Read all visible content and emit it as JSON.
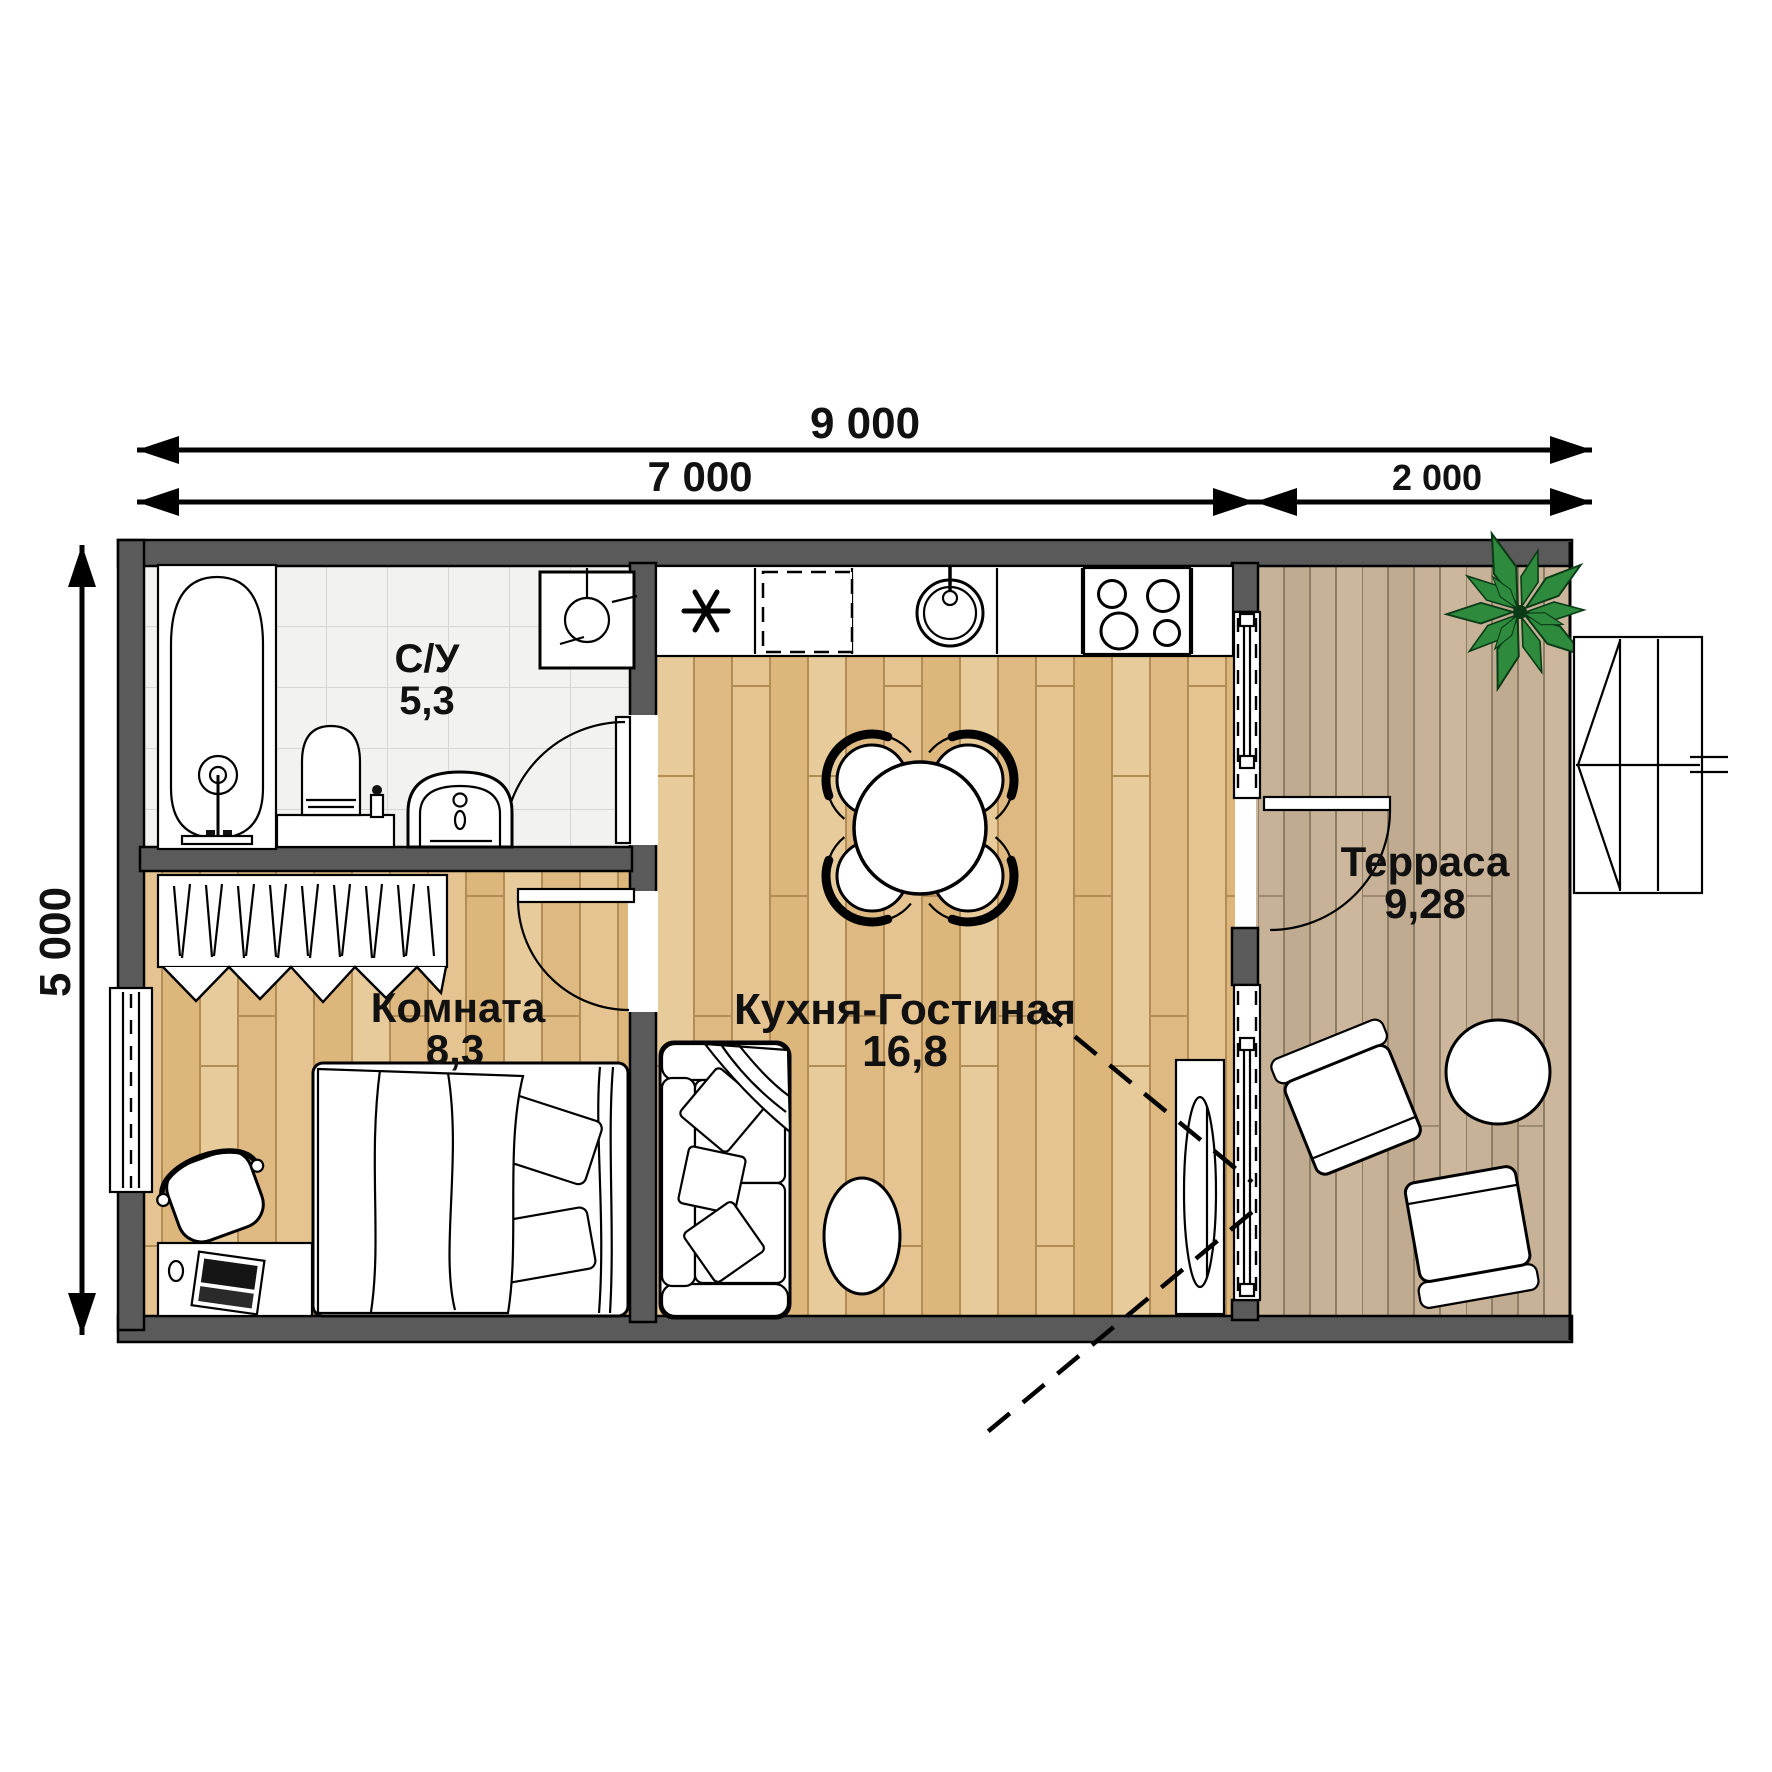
{
  "page": {
    "type": "architectural floor plan",
    "background": "#ffffff"
  },
  "dimensions": {
    "total_width": "9 000",
    "main_width": "7 000",
    "terrace_width": "2 000",
    "depth": "5 000"
  },
  "rooms": {
    "bathroom": {
      "name": "С/У",
      "area": "5,3"
    },
    "bedroom": {
      "name": "Комната",
      "area": "8,3"
    },
    "kitchen_living": {
      "name": "Кухня-Гостиная",
      "area": "16,8"
    },
    "terrace": {
      "name": "Терраса",
      "area": "9,28"
    }
  },
  "colors": {
    "wall": "#5a5a5a",
    "ink": "#111111",
    "wood": "#e2c08c",
    "deck": "#c7b298",
    "tile": "#f2f2f1",
    "plant": "#2e8b3d"
  },
  "icons": {
    "fridge": "snowflake-asterisk",
    "dishwasher": "dashed-square",
    "sink": "round-basin-with-tap",
    "stove": "four-burner-rings",
    "washing_machine": "drum-with-blades",
    "plant": "leafy-plant",
    "stairs": "entry-steps"
  }
}
